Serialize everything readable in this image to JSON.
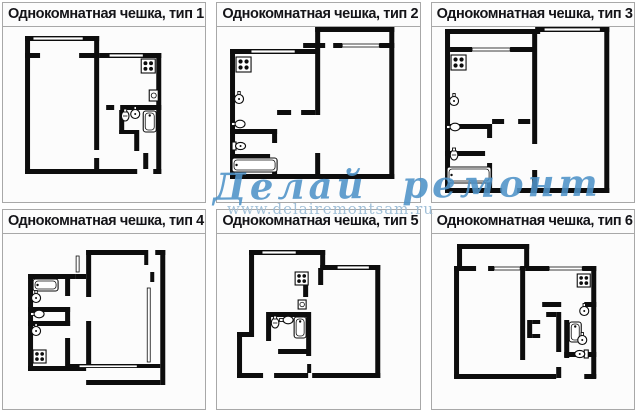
{
  "watermark": {
    "script": "Делай ремонт сам",
    "url": "www.delairemontsam.ru",
    "script_color": "#4e93c8",
    "url_color": "#9dbdd6"
  },
  "styles": {
    "wall_color": "#0d0d0d",
    "border_color": "#a8a8a8",
    "title_color": "#141418",
    "panel_bg": "#fcfcfc",
    "page_bg": "#ffffff"
  },
  "panels": [
    {
      "title": "Однокомнатная чешка, тип 1",
      "plan": "p1"
    },
    {
      "title": "Однокомнатная чешка, тип 2",
      "plan": "p2"
    },
    {
      "title": "Однокомнатная чешка, тип 3",
      "plan": "p3"
    },
    {
      "title": "Однокомнатная чешка, тип 4",
      "plan": "p4"
    },
    {
      "title": "Однокомнатная чешка, тип 5",
      "plan": "p5"
    },
    {
      "title": "Однокомнатная чешка, тип 6",
      "plan": "p6"
    }
  ],
  "plans": {
    "p1": {
      "walls": [
        [
          22,
          9,
          5,
          138
        ],
        [
          22,
          9,
          74,
          5
        ],
        [
          91,
          9,
          5,
          114
        ],
        [
          91,
          131,
          5,
          16
        ],
        [
          22,
          26,
          15,
          5
        ],
        [
          76,
          26,
          20,
          5
        ],
        [
          96,
          26,
          62,
          5
        ],
        [
          153,
          26,
          5,
          121
        ],
        [
          103,
          78,
          8,
          5
        ],
        [
          117,
          78,
          41,
          5
        ],
        [
          116,
          83,
          5,
          24
        ],
        [
          116,
          103,
          20,
          4
        ],
        [
          131,
          107,
          5,
          17
        ],
        [
          140,
          126,
          5,
          16
        ],
        [
          22,
          142,
          112,
          5
        ],
        [
          150,
          142,
          8,
          5
        ]
      ],
      "windows": [
        [
          30,
          10,
          50,
          3
        ],
        [
          106,
          27,
          34,
          3
        ]
      ],
      "fixtures": [
        {
          "t": "stove",
          "x": 138,
          "y": 32,
          "s": 14
        },
        {
          "t": "box",
          "x": 146,
          "y": 63,
          "w": 9,
          "h": 11
        },
        {
          "t": "basin",
          "x": 122,
          "y": 89
        },
        {
          "t": "sink",
          "x": 132,
          "y": 87
        },
        {
          "t": "tubV",
          "x": 140,
          "y": 84,
          "w": 13,
          "h": 21
        }
      ]
    },
    "p2": {
      "walls": [
        [
          13,
          22,
          5,
          130
        ],
        [
          13,
          22,
          86,
          5
        ],
        [
          98,
          0,
          79,
          5
        ],
        [
          172,
          0,
          5,
          152
        ],
        [
          98,
          0,
          5,
          88
        ],
        [
          98,
          126,
          5,
          26
        ],
        [
          86,
          16,
          22,
          5
        ],
        [
          116,
          16,
          9,
          5
        ],
        [
          162,
          16,
          15,
          5
        ],
        [
          13,
          147,
          164,
          5
        ],
        [
          13,
          102,
          47,
          5
        ],
        [
          55,
          102,
          5,
          14
        ],
        [
          55,
          138,
          5,
          9
        ],
        [
          13,
          127,
          40,
          5
        ],
        [
          60,
          83,
          14,
          5
        ],
        [
          84,
          83,
          14,
          5
        ]
      ],
      "windows": [
        [
          34,
          23,
          44,
          3
        ],
        [
          125,
          17,
          37,
          3
        ]
      ],
      "fixtures": [
        {
          "t": "stove",
          "x": 19,
          "y": 30,
          "s": 15
        },
        {
          "t": "sink",
          "x": 22,
          "y": 72
        },
        {
          "t": "wallSink",
          "x": 23,
          "y": 97
        },
        {
          "t": "toilet",
          "x": 23,
          "y": 119
        },
        {
          "t": "tubH",
          "x": 15,
          "y": 131,
          "w": 45,
          "h": 14
        }
      ]
    },
    "p3": {
      "walls": [
        [
          13,
          2,
          95,
          5
        ],
        [
          13,
          2,
          5,
          164
        ],
        [
          103,
          0,
          74,
          5
        ],
        [
          172,
          0,
          5,
          166
        ],
        [
          18,
          20,
          22,
          5
        ],
        [
          78,
          20,
          25,
          5
        ],
        [
          100,
          7,
          5,
          110
        ],
        [
          100,
          143,
          5,
          23
        ],
        [
          13,
          161,
          57,
          5
        ],
        [
          85,
          161,
          92,
          5
        ],
        [
          13,
          97,
          45,
          5
        ],
        [
          55,
          97,
          5,
          14
        ],
        [
          55,
          136,
          5,
          25
        ],
        [
          60,
          92,
          12,
          5
        ],
        [
          86,
          92,
          12,
          5
        ],
        [
          13,
          124,
          40,
          5
        ]
      ],
      "windows": [
        [
          40,
          21,
          38,
          3
        ],
        [
          112,
          1,
          56,
          3
        ]
      ],
      "fixtures": [
        {
          "t": "stove",
          "x": 19,
          "y": 28,
          "s": 15
        },
        {
          "t": "sink",
          "x": 22,
          "y": 74
        },
        {
          "t": "wallSink",
          "x": 23,
          "y": 100
        },
        {
          "t": "basin",
          "x": 22,
          "y": 128
        },
        {
          "t": "tubH",
          "x": 15,
          "y": 140,
          "w": 44,
          "h": 16
        }
      ]
    },
    "p4": {
      "walls": [
        [
          25,
          40,
          47,
          5
        ],
        [
          25,
          40,
          5,
          97
        ],
        [
          25,
          132,
          58,
          5
        ],
        [
          25,
          73,
          42,
          5
        ],
        [
          25,
          87,
          42,
          5
        ],
        [
          62,
          45,
          5,
          17
        ],
        [
          62,
          73,
          5,
          19
        ],
        [
          62,
          104,
          5,
          28
        ],
        [
          72,
          40,
          11,
          5
        ],
        [
          83,
          16,
          62,
          5
        ],
        [
          152,
          16,
          10,
          5
        ],
        [
          157,
          16,
          5,
          135
        ],
        [
          83,
          146,
          74,
          5
        ],
        [
          83,
          16,
          5,
          47
        ],
        [
          83,
          87,
          5,
          47
        ],
        [
          63,
          130,
          94,
          4
        ],
        [
          147,
          38,
          4,
          10
        ],
        [
          141,
          21,
          4,
          10
        ]
      ],
      "windows": [
        [
          76,
          131,
          58,
          2.5
        ],
        [
          144,
          54,
          3,
          74
        ],
        [
          73,
          22,
          3,
          16
        ]
      ],
      "fixtures": [
        {
          "t": "tubH",
          "x": 30,
          "y": 45,
          "w": 25,
          "h": 12
        },
        {
          "t": "sink",
          "x": 33,
          "y": 64
        },
        {
          "t": "wallSink",
          "x": 36,
          "y": 80
        },
        {
          "t": "sink",
          "x": 33,
          "y": 97
        },
        {
          "t": "stove",
          "x": 30,
          "y": 116,
          "s": 13
        }
      ]
    },
    "p5": {
      "walls": [
        [
          32,
          16,
          5,
          82
        ],
        [
          32,
          16,
          76,
          5
        ],
        [
          103,
          16,
          5,
          18
        ],
        [
          103,
          31,
          60,
          5
        ],
        [
          158,
          31,
          5,
          113
        ],
        [
          20,
          98,
          17,
          5
        ],
        [
          20,
          98,
          5,
          46
        ],
        [
          20,
          139,
          26,
          5
        ],
        [
          57,
          139,
          34,
          5
        ],
        [
          95,
          139,
          68,
          5
        ],
        [
          90,
          130,
          4,
          9
        ],
        [
          101,
          34,
          5,
          17
        ],
        [
          86,
          50,
          5,
          13
        ],
        [
          49,
          78,
          42,
          5
        ],
        [
          49,
          83,
          5,
          24
        ],
        [
          61,
          115,
          30,
          5
        ],
        [
          89,
          78,
          5,
          44
        ]
      ],
      "windows": [
        [
          45,
          17,
          34,
          3
        ],
        [
          120,
          32,
          32,
          3
        ]
      ],
      "fixtures": [
        {
          "t": "stove",
          "x": 78,
          "y": 38,
          "s": 13
        },
        {
          "t": "box",
          "x": 81,
          "y": 66,
          "w": 8,
          "h": 9
        },
        {
          "t": "basin",
          "x": 58,
          "y": 89
        },
        {
          "t": "wallSink",
          "x": 71,
          "y": 86
        },
        {
          "t": "tubV",
          "x": 77,
          "y": 83,
          "w": 12,
          "h": 21
        }
      ]
    },
    "p6": {
      "walls": [
        [
          25,
          10,
          72,
          5
        ],
        [
          25,
          10,
          5,
          24
        ],
        [
          92,
          10,
          5,
          24
        ],
        [
          22,
          32,
          5,
          112
        ],
        [
          22,
          32,
          22,
          5
        ],
        [
          56,
          32,
          6,
          5
        ],
        [
          88,
          32,
          5,
          94
        ],
        [
          93,
          32,
          24,
          5
        ],
        [
          150,
          32,
          14,
          5
        ],
        [
          159,
          32,
          5,
          112
        ],
        [
          110,
          68,
          19,
          5
        ],
        [
          152,
          68,
          12,
          5
        ],
        [
          124,
          78,
          5,
          40
        ],
        [
          114,
          78,
          10,
          5
        ],
        [
          132,
          86,
          5,
          38
        ],
        [
          132,
          118,
          12,
          5
        ],
        [
          156,
          118,
          8,
          5
        ],
        [
          124,
          133,
          5,
          11
        ],
        [
          22,
          140,
          102,
          5
        ],
        [
          152,
          140,
          12,
          5
        ],
        [
          95,
          86,
          5,
          18
        ],
        [
          100,
          86,
          8,
          4
        ],
        [
          100,
          100,
          8,
          4
        ]
      ],
      "windows": [
        [
          62,
          33,
          26,
          3
        ],
        [
          117,
          33,
          33,
          3
        ]
      ],
      "fixtures": [
        {
          "t": "stove",
          "x": 145,
          "y": 40,
          "s": 13
        },
        {
          "t": "sink",
          "x": 152,
          "y": 77
        },
        {
          "t": "tubV",
          "x": 137,
          "y": 88,
          "w": 12,
          "h": 20
        },
        {
          "t": "sink",
          "x": 150,
          "y": 106
        },
        {
          "t": "toilet",
          "x": 148,
          "y": 120,
          "rot": 180
        }
      ]
    }
  }
}
